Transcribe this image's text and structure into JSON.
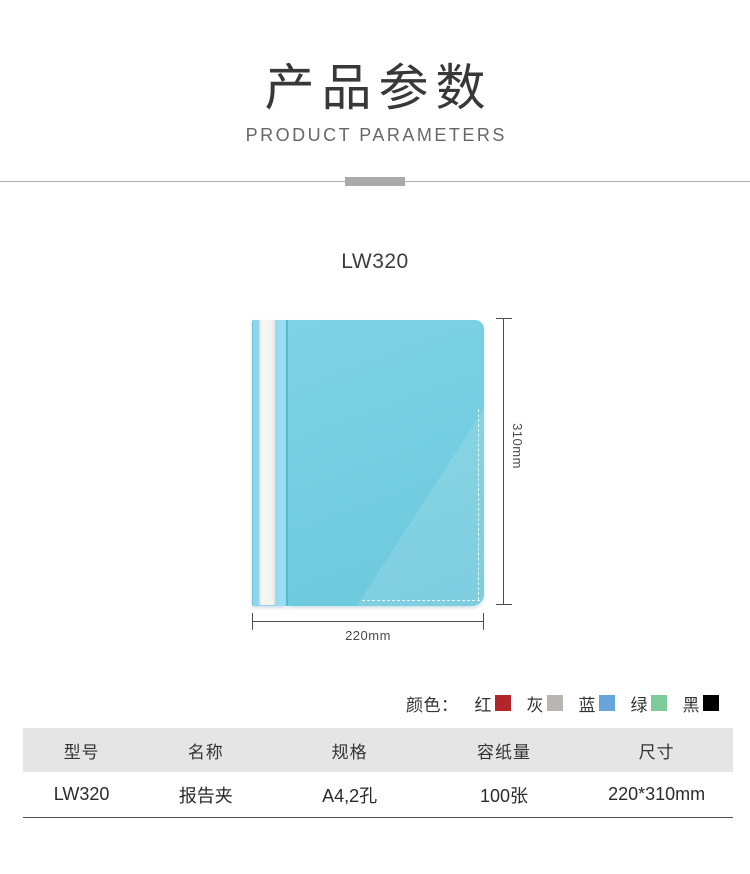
{
  "header": {
    "title": "产品参数",
    "subtitle": "PRODUCT PARAMETERS"
  },
  "product": {
    "model": "LW320",
    "height_label": "310mm",
    "width_label": "220mm",
    "folder_color": "#75cee1"
  },
  "colors": {
    "label": "颜色：",
    "options": [
      {
        "name": "红",
        "hex": "#b2252b"
      },
      {
        "name": "灰",
        "hex": "#b9b6b1"
      },
      {
        "name": "蓝",
        "hex": "#68a4dc"
      },
      {
        "name": "绿",
        "hex": "#7ccb98"
      },
      {
        "name": "黑",
        "hex": "#000000"
      }
    ]
  },
  "table": {
    "headers": [
      "型号",
      "名称",
      "规格",
      "容纸量",
      "尺寸"
    ],
    "rows": [
      [
        "LW320",
        "报告夹",
        "A4,2孔",
        "100张",
        "220*310mm"
      ]
    ]
  }
}
